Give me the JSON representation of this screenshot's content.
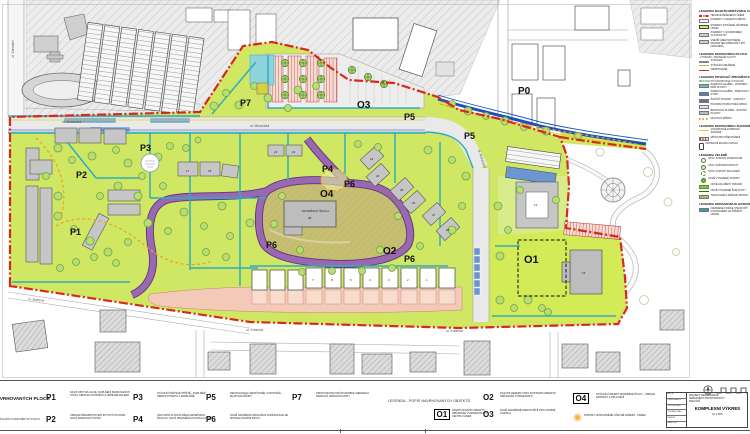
{
  "colors": {
    "boundary_red": "#d8281c",
    "design_green": "#cfe763",
    "khaki_zone": "#c6bf72",
    "road_purple": "#9a68b0",
    "path_teal": "#2fadc0",
    "parking_blue": "#6b96d2",
    "paving_salmon": "#f3c9b7",
    "stream_blue": "#1a4fc0",
    "marking_yellow": "#e3d31c",
    "accent_orange": "#f0a01e"
  },
  "map": {
    "zones": [
      "P1",
      "P2",
      "P3",
      "P4",
      "P5",
      "P5",
      "P6",
      "P6",
      "P6",
      "P7",
      "O1",
      "O2",
      "O3",
      "O4",
      "P0"
    ],
    "streets": [
      "ul. Moravská",
      "ul. Moravská",
      "ul. Moravská",
      "ul. Krásová",
      "ul. Krásová",
      "ul. Buková",
      "ul. Zahradní"
    ],
    "school": {
      "line1": "MATEŘSKÁ ŠKOLA",
      "line2": "38"
    },
    "building_numbers": [
      "17",
      "18",
      "21",
      "22",
      "23",
      "24",
      "25",
      "26",
      "27",
      "28",
      "12",
      "16"
    ],
    "row_house_numbers": [
      "7",
      "6",
      "5",
      "4",
      "3",
      "2",
      "1"
    ]
  },
  "legend_right": {
    "sections": [
      {
        "title": "LEGENDA MAJETKOPRÁVNÍCH VZTAHŮ",
        "items": [
          {
            "label": "HRANICE ŘEŠENÉHO ÚZEMÍ"
          },
          {
            "label": "POZEMKY V MAJETKU MĚSTA"
          },
          {
            "label": "POZEMKY DOTČENÉ NÁVRHEM ÚPRAV"
          },
          {
            "label": "POZEMKY V SOUKROMÉM VLASTNICTVÍ"
          },
          {
            "label": "VNĚJŠÍ ÚZEMÍ DOTČENÉ PROJEKTEM (PŘELOŽKY SÍTÍ, NAPOJENÍ)"
          }
        ]
      },
      {
        "title": "LEGENDA DOPRAVNÍCH PLOCH",
        "subtitle": "- CHODNÍKY, ZPEVNĚNÉ PLOCHY",
        "items": [
          {
            "label": "STÁVAJÍCÍ"
          },
          {
            "label": "STÁVAJÍCÍ ZRUŠENÉ"
          },
          {
            "label": "NAVRHOVANÉ"
          }
        ]
      },
      {
        "title": "LEGENDA POVRCHŮ ZPEVNĚNÝCH PLOCH",
        "subtitle": "PRO PLOCHY NAVRHOVANÉ I STÁVAJÍCÍ",
        "items": [
          {
            "label": "ZÁMKOVÁ DLAŽBA - CHODNÍKY, PĚŠÍ PLOCHY"
          },
          {
            "label": "ZÁMKOVÁ DLAŽBA - PARKOVACÍ STÁNÍ"
          },
          {
            "label": "ŽIVIČNÝ POVRCH - VOZOVKY"
          },
          {
            "label": "PŮVODNÍ POVRCH BEZ ÚPRAV"
          },
          {
            "label": "BETONOVÁ DLAŽBA - OSTATNÍ PLOCHY"
          },
          {
            "label": "MLATOVÁ PĚŠINA"
          }
        ]
      },
      {
        "title": "LEGENDA DOPRAVNÍHO ZNAČENÍ",
        "items": [
          {
            "label": "VODOROVNÉ DOPRAVNÍ ZNAČENÍ"
          },
          {
            "label": "MÍSTA PRO PŘECHÁZENÍ"
          },
          {
            "label": "DOPRAVNÍ ZNAČKA SVISLÁ"
          }
        ]
      },
      {
        "title": "LEGENDA ZELENĚ",
        "items": [
          {
            "label": "STÁV. STROMY PONECHANÉ"
          },
          {
            "label": "STÁV. KEŘOVÉ POROSTY"
          },
          {
            "label": "STÁV. STROMY KE KÁCENÍ"
          },
          {
            "label": "NOVĚ VYSAZENÉ STROMY"
          },
          {
            "label": "NOVĚ ZALOŽENÝ TRÁVNÍK"
          },
          {
            "label": "NOVĚ VYSAZENÉ ŽIVÉ PLOTY"
          },
          {
            "label": "TRVALKOVÉ A KEŘOVÉ ZÁHONY"
          }
        ]
      },
      {
        "title": "LEGENDA ODPADOVÉHO HOSPODÁŘSTVÍ",
        "items": [
          {
            "label": "NAVRŽENÉ POZICE STANOVIŠŤ KONTEJNERŮ NA TŘÍDĚNÝ ODPAD"
          }
        ]
      }
    ]
  },
  "legend_bottom": {
    "header": "LEGENDA NAVRHOVANÝCH PLOCH",
    "header_note": "— STAVEBNÍ ÚPRAVY STÁVAJÍCÍCH ZPEVNĚNÝCH PLOCH",
    "plochy": [
      {
        "id": "P1",
        "desc": "NOVÁ OBYTNÁ ULICE, DOPLNĚNÍ PARKOVACÍCH STÁNÍ, OBNOVA CHODNÍKŮ A VEŘEJNÉ ZELENĚ"
      },
      {
        "id": "P2",
        "desc": "ÚPRAVA PŘEDPROSTORŮ BYTOVÝCH DOMŮ, NOVÁ PARKOVACÍ STÁNÍ"
      },
      {
        "id": "P3",
        "desc": "STÁVAJÍCÍ DĚTSKÉ HŘIŠTĚ - DOPLNĚNÍ HERNÍCH PRVKŮ A MOBILIÁŘE"
      },
      {
        "id": "P4",
        "desc": "NÁSTUPNÍ PLOCHA PŘED MATEŘSKOU ŠKOLOU, NOVÁ ZPEVNĚNÁ PLOCHA A ZELEŇ"
      },
      {
        "id": "P5",
        "desc": "REVITALIZACE ÚZEMÍ PODÉL VODOTEČE, MLATOVÉ PĚŠINY"
      },
      {
        "id": "P6",
        "desc": "NOVĚ NAVRŽENÁ OBSLUŽNÁ KOMUNIKACE SE ZPOMALOVACÍMI PRVKY"
      },
      {
        "id": "P7",
        "desc": "PROSTOR PRO KRÁTKODOBOU REKREACI, PARKOVÁ ÚPRAVA PLOCHY"
      }
    ],
    "objects_header": "LEGENDA - POPIS NAVRHOVANÝCH OBJEKTŮ",
    "objects": [
      {
        "id": "O1",
        "desc": "NÁVRH NOVÉHO OBJEKTU OBČANSKÉ VYBAVENOSTI V CENTRU ÚZEMÍ"
      },
      {
        "id": "O2",
        "desc": "PLOCHA REZERVY PRO DOSTAVBU OBJEKTU OBČANSKÉ VYBAVENOSTI"
      },
      {
        "id": "O3",
        "desc": "NOVĚ NAVRŽENÉ PARKOVIŠTĚ PRO OSOBNÍ VOZIDLA"
      },
      {
        "id": "O4",
        "desc": "STÁVAJÍCÍ OBJEKT MATEŘSKÉ ŠKOLY - ÚPRAVA ZAHRADY A OPLOCENÍ"
      }
    ],
    "note": "STROMY ODSTRANĚNÉ VČETNĚ PAŘEZŮ - PAŘEZ"
  },
  "title_block": {
    "rows": [
      "AKCE",
      "OBJEDNATEL",
      "PROJEKTANT",
      "VYPRACOVAL",
      "DATUM",
      "MĚŘÍTKO"
    ],
    "project_lines": [
      "PROJEKT REGENERACE",
      "VEŘEJNÉHO PROSTRANSTVÍ",
      "SÍDLIŠTĚ"
    ],
    "drawing_title": "KOMPLEXNÍ VÝKRES",
    "scale": "M 1:500"
  }
}
